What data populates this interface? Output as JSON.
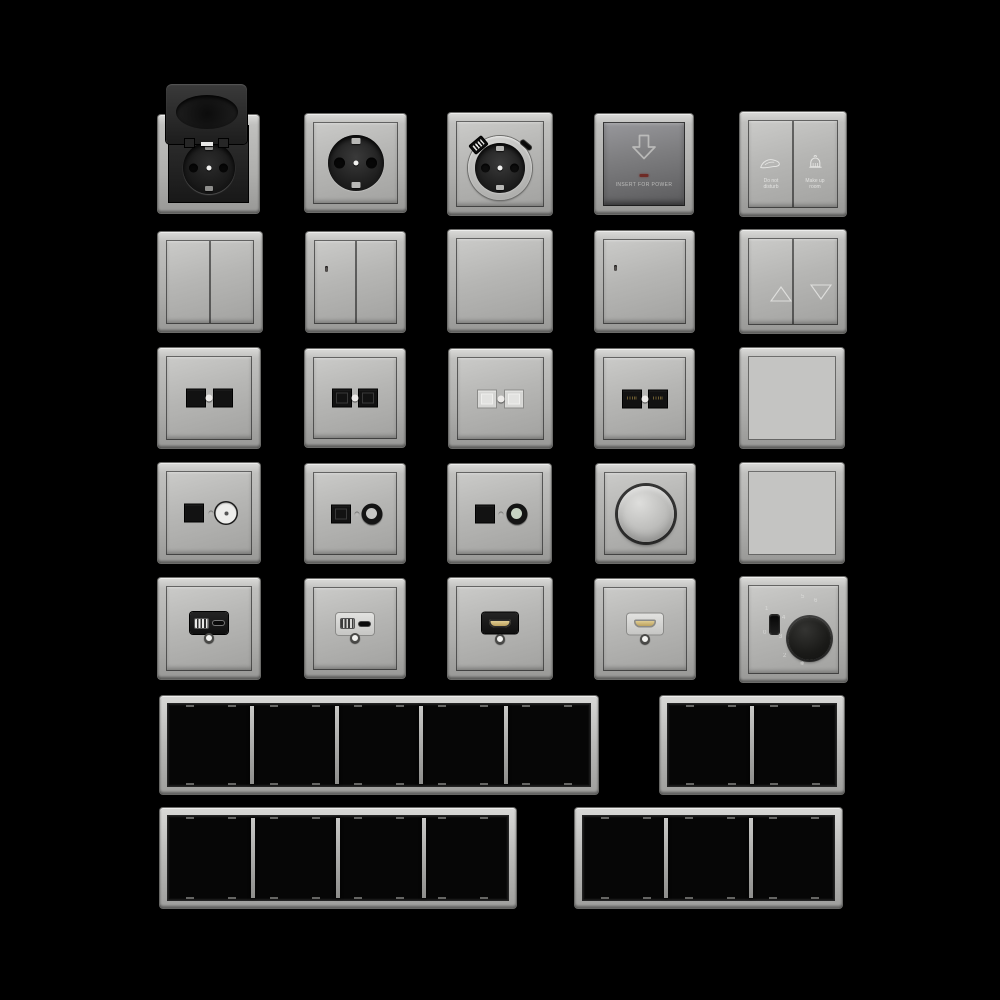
{
  "scene": {
    "description": "Product render sheet of grey electrical wall fixtures on black background",
    "colors": {
      "background": "#000000",
      "plate_light": "#bcbcba",
      "plate_dark": "#7e7e80",
      "module_black": "#161616",
      "led_red": "#6e2b26",
      "hdmi_gold": "#cdb878",
      "coax_green": "#c6d2c2"
    }
  },
  "inventory": {
    "row1": [
      "socket-outlet-hinged-lid-open",
      "schuko-socket-outlet",
      "schuko-socket-outlet-usb-a-c",
      "key-card-power-switch",
      "hotel-service-double-switch"
    ],
    "row2": [
      "double-rocker-switch",
      "double-rocker-switch-indicator",
      "single-rocker-switch",
      "single-rocker-switch-indicator",
      "shutter-blinds-double-switch"
    ],
    "row3": [
      "data-outlet-2port-black",
      "rj45-outlet-2port-keystone",
      "data-outlet-2port-shuttered-light",
      "rj45-outlet-2port-gold-contacts",
      "blank-rocker-plate"
    ],
    "row4": [
      "tv-data-combo-outlet-white-coax",
      "tv-data-combo-outlet-dark-coax",
      "tv-data-combo-outlet-green-coax",
      "rotary-dimmer",
      "blank-cover-plate"
    ],
    "row5": [
      "usb-a-c-charger-outlet-black",
      "usb-a-c-charger-outlet-light",
      "hdmi-outlet-black",
      "hdmi-outlet-light",
      "thermostat-rotary-with-switch"
    ],
    "row6": [
      "frame-5-gang",
      "frame-2-gang"
    ],
    "row7": [
      "frame-4-gang",
      "frame-3-gang"
    ]
  },
  "labels": {
    "card_switch": "INSERT FOR POWER",
    "dnd1": "Do not",
    "dnd2": "disturb",
    "mur1": "Make up",
    "mur2": "room"
  },
  "icons": {
    "card": "card-arrow-down-icon",
    "dnd": "do-not-disturb-hand-icon",
    "mur": "make-up-room-bell-icon",
    "blinds_up": "blinds-up-triangle-icon",
    "blinds_down": "blinds-down-triangle-icon",
    "snowflake": "frost-protection-icon"
  },
  "thermostat": {
    "slider_on": "1",
    "slider_off": "0",
    "m2": "2",
    "m3": "3",
    "m4": "4",
    "m5": "5",
    "m6": "6",
    "snow": "❄"
  }
}
